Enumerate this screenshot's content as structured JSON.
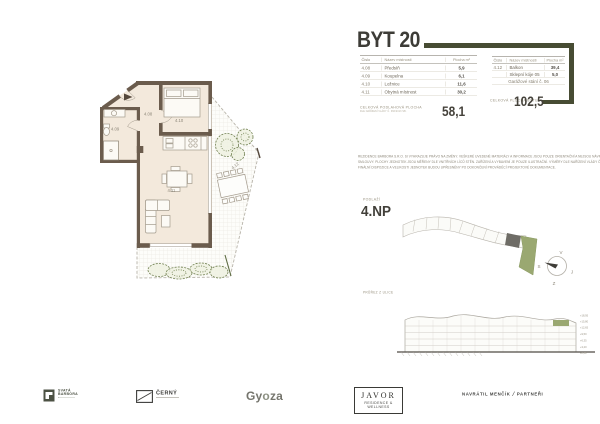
{
  "title": "BYT 20",
  "tables": {
    "left": {
      "headers": {
        "num": "Číslo",
        "name": "Název místnosti",
        "area": "Plocha m²"
      },
      "rows": [
        {
          "num": "4.08",
          "name": "Předsíň",
          "area": "5,9"
        },
        {
          "num": "4.09",
          "name": "Koupelna",
          "area": "6,1"
        },
        {
          "num": "4.10",
          "name": "Ložnice",
          "area": "11,6"
        },
        {
          "num": "4.11",
          "name": "Obytná místnost",
          "area": "30,2"
        }
      ],
      "total_label": "CELKOVÁ PODLAHOVÁ PLOCHA",
      "total_note": "DLE NAŘÍZENÍ VLÁDY Č. 366/2013 SB.",
      "total_value": "58,1"
    },
    "right": {
      "headers": {
        "num": "Číslo",
        "name": "Název místnosti",
        "area": "Plocha m²"
      },
      "rows": [
        {
          "num": "4.12",
          "name": "Balkon",
          "area": "39,4"
        },
        {
          "num": "",
          "name": "Sklepní kóje 05",
          "area": "5,0"
        }
      ],
      "span_row": "Garážové stání č. 06",
      "total_label": "CELKOVÁ PLOCHA BYTU",
      "total_value": "102,5"
    }
  },
  "disclaimer": {
    "line1": "REZIDENCE BARBORA S.R.O. SI VYHRAZUJE PRÁVO NA ZMĚNY. VEŠKERÉ UVEDENÉ MATERIÁLY A INFORMACE JSOU POUZE ORIENTAČNÍ A NEJSOU NÁVRHEM NA UZAVŘENÍ KUPNÍ",
    "line2": "SMLOUVY. PLOCHY JEDNOTEK JSOU MĚŘENY DLE VNITŘNÍCH LÍCŮ STĚN. ZAŘÍZENÍ A VYBAVENÍ JE POUZE ILUSTRAČNÍ. VÝMĚRY DLE NAŘÍZENÍ VLÁDY Č. 366/2013 SB.",
    "line3": "FINÁLNÍ DISPOZICE A VELIKOSTI JEDNOTEK BUDOU UPŘESNĚNY PO DOKONČENÍ PROVÁDĚCÍ PROJEKTOVÉ DOKUMENTACE."
  },
  "floor": {
    "label": "PODLAŽÍ",
    "value": "4.NP"
  },
  "section": {
    "label": "PRŮŘEZ Z ULICE",
    "levels": [
      "+18,95",
      "+15,80",
      "+12,65",
      "+9,50",
      "+6,35",
      "+3,20",
      "±0,00"
    ]
  },
  "compass": {
    "top": "V",
    "left": "S",
    "right": "J",
    "bottom": "Z"
  },
  "plan": {
    "labels": {
      "hall": "4.08",
      "bath": "4.09",
      "bedroom": "4.10",
      "living": "4.11",
      "balcony": "4.12"
    }
  },
  "footer": {
    "barbora_line1": "SVATÁ",
    "barbora_line2": "BARBORA",
    "cerny": "ČERNÝ",
    "gyoza_a": "Gy",
    "gyoza_o": "o",
    "gyoza_b": "za",
    "javor": "JAVOR",
    "javor_sub": "RESIDENCE & WELLNESS",
    "navratil": "NAVRÁTIL MENČÍK",
    "navratil_sep": "/",
    "navratil_partner": "PARTNEŘI"
  },
  "colors": {
    "accent": "#474c33",
    "wall": "#6b5c4d",
    "floor": "#f3e9dc",
    "highlight_green": "#9aa871"
  }
}
